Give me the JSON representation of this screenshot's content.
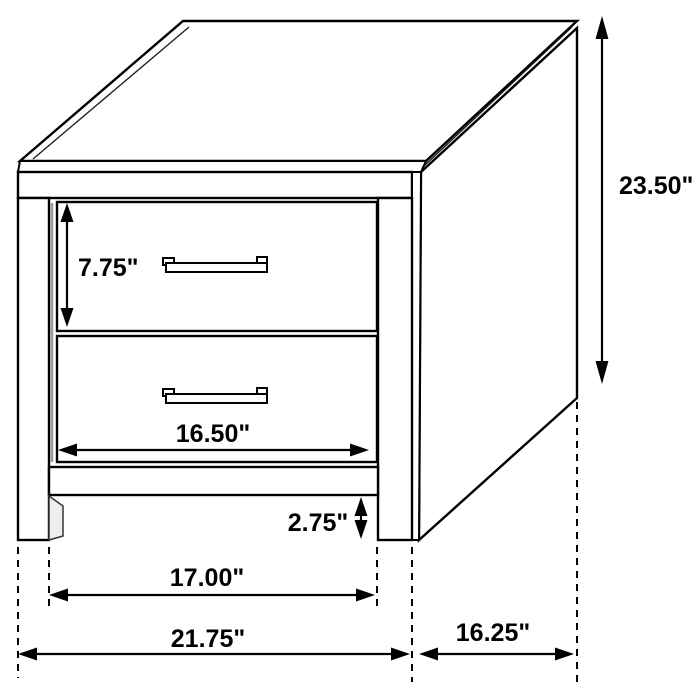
{
  "diagram": {
    "subject": "Two-drawer nightstand line drawing with dimension arrows",
    "units": "inches",
    "colors": {
      "line": "#000000",
      "background": "#ffffff",
      "shade_line": "#9a9a9a"
    },
    "dimensions": {
      "drawer_height": {
        "label": "7.75\"",
        "value": 7.75
      },
      "overall_height": {
        "label": "23.50\"",
        "value": 23.5
      },
      "drawer_width": {
        "label": "16.50\"",
        "value": 16.5
      },
      "base_clearance": {
        "label": "2.75\"",
        "value": 2.75
      },
      "leg_span_width": {
        "label": "17.00\"",
        "value": 17.0
      },
      "overall_width": {
        "label": "21.75\"",
        "value": 21.75
      },
      "depth": {
        "label": "16.25\"",
        "value": 16.25
      }
    }
  }
}
